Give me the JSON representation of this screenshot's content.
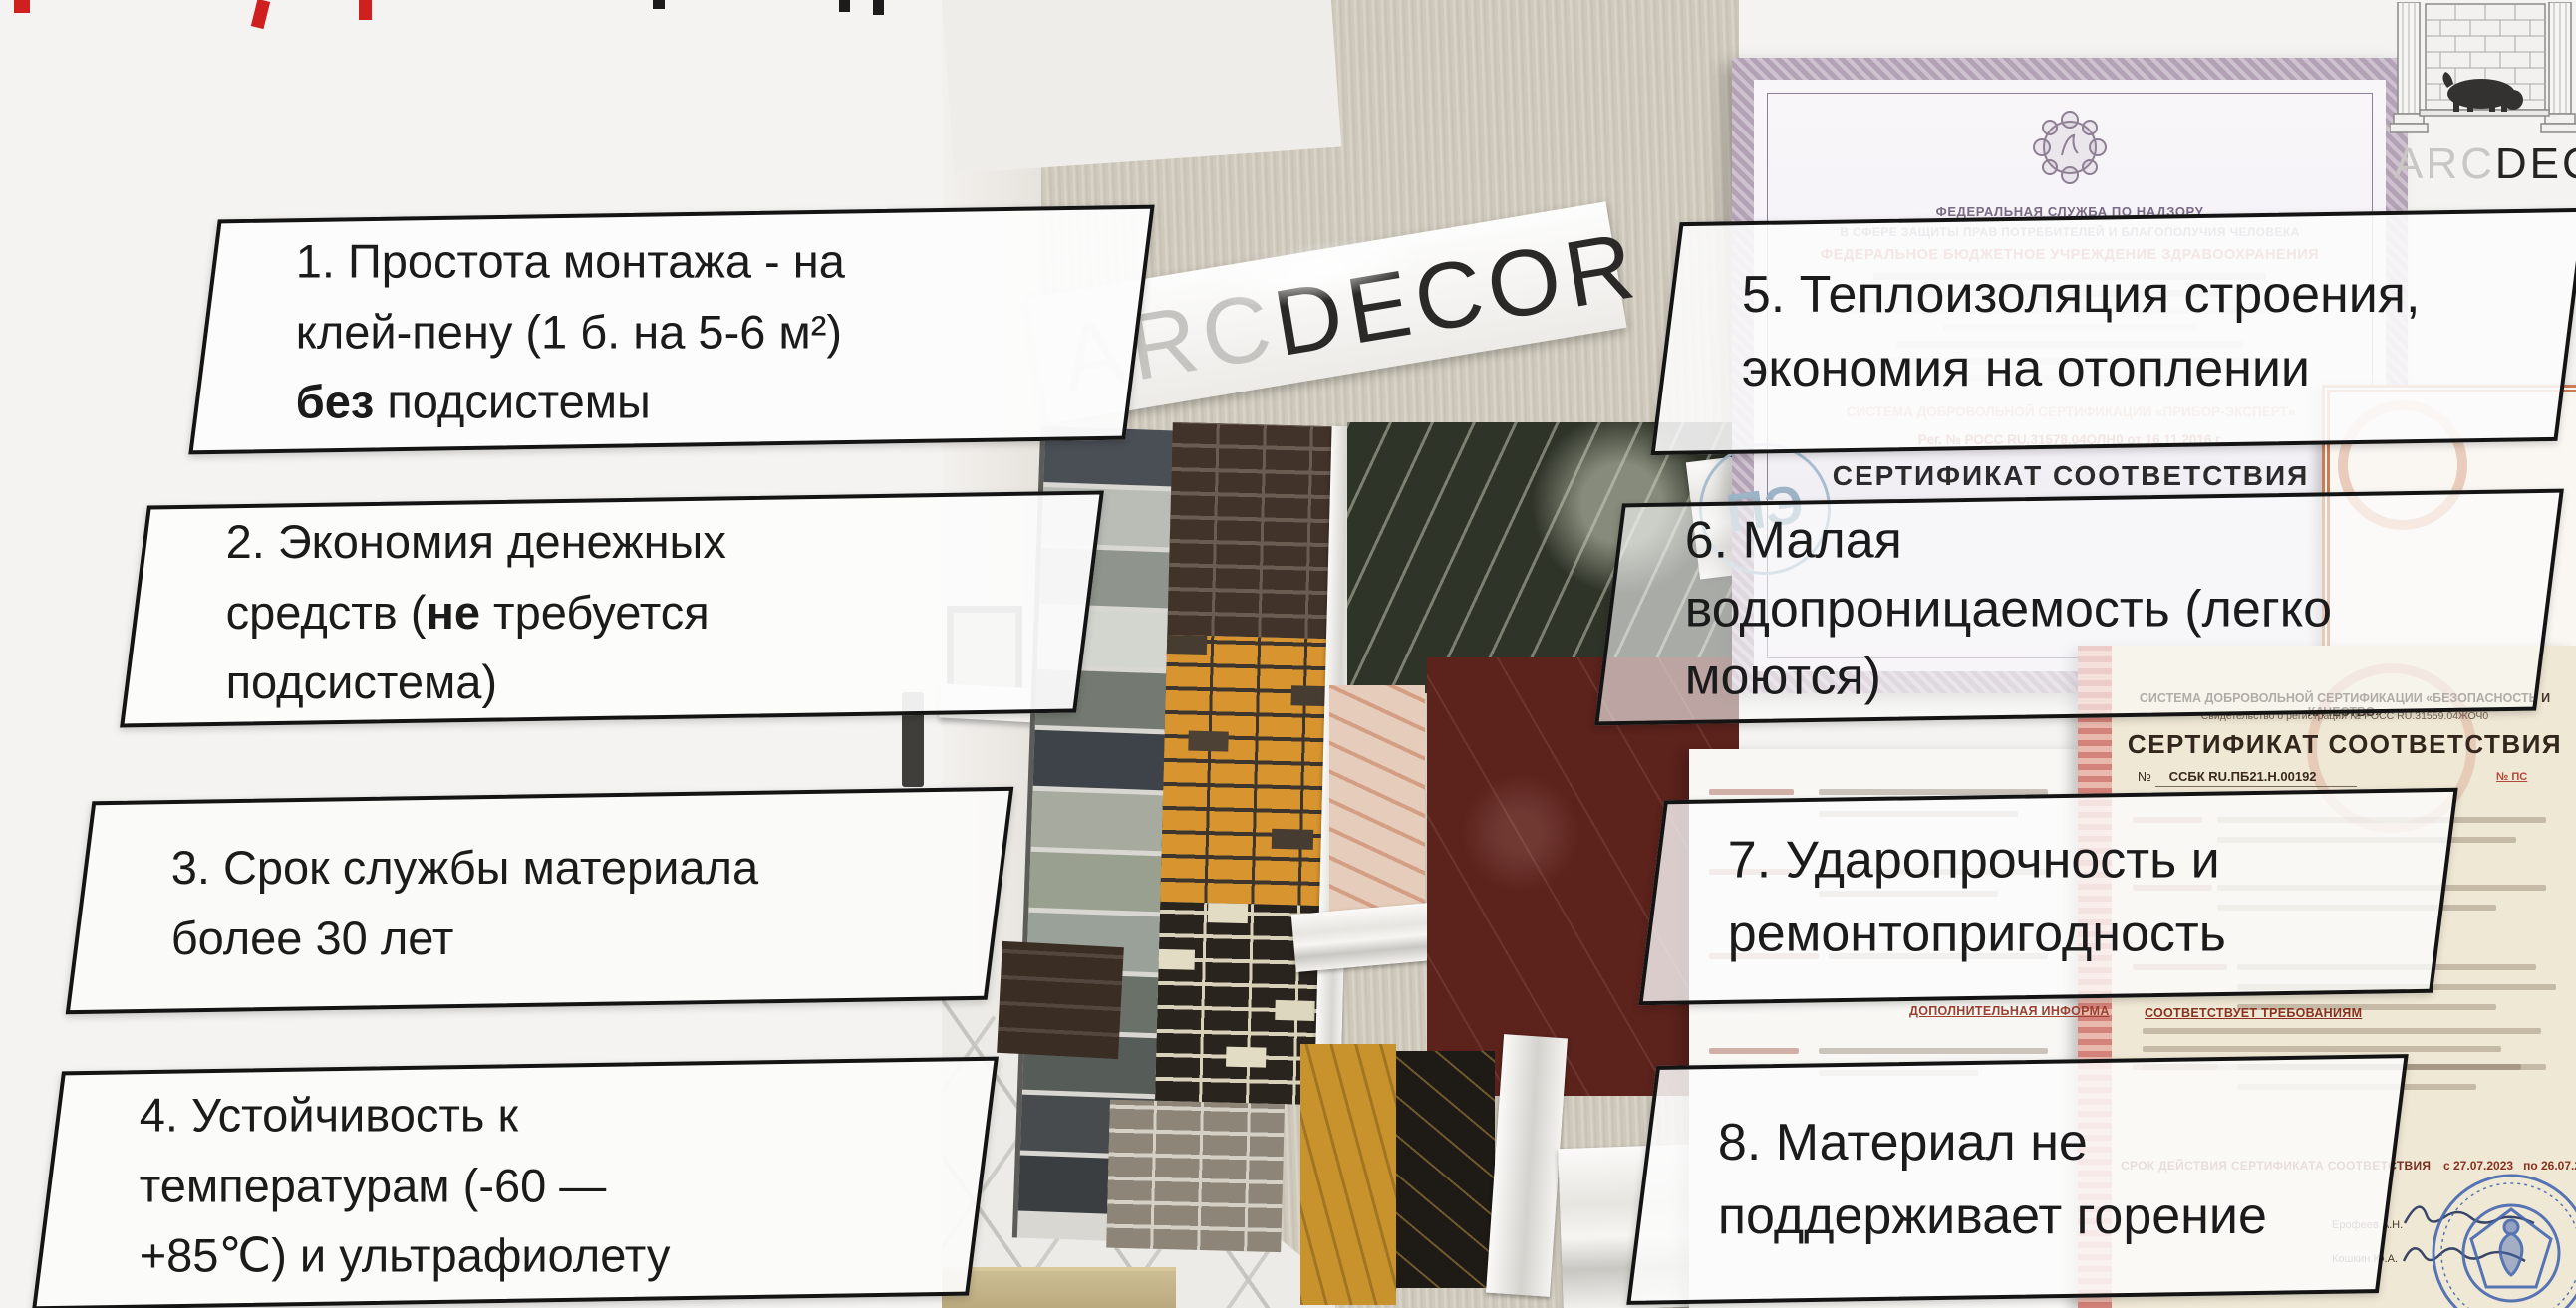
{
  "slide": {
    "background": "#f4f3f1",
    "accent_red": "#cf1f1f"
  },
  "callouts": {
    "text_color": "#1b1b1b",
    "border_color": "#141414",
    "boxes": [
      {
        "id": "1",
        "lines": [
          {
            "pre": "1. Простота монтажа - на"
          },
          {
            "pre": "клей-пену (1 б. на 5-6 м²)"
          },
          {
            "pre": "",
            "bold": "без",
            "post": " подсистемы"
          }
        ]
      },
      {
        "id": "2",
        "lines": [
          {
            "pre": "2. Экономия денежных"
          },
          {
            "pre": "средств (",
            "bold": "не",
            "post": " требуется"
          },
          {
            "pre": "подсистема)"
          }
        ]
      },
      {
        "id": "3",
        "lines": [
          {
            "pre": "3. Срок службы материала"
          },
          {
            "pre": "более 30 лет"
          }
        ]
      },
      {
        "id": "4",
        "lines": [
          {
            "pre": "4. Устойчивость к"
          },
          {
            "pre": "температурам (-60 —"
          },
          {
            "pre": "+85℃) и ультрафиолету"
          }
        ]
      },
      {
        "id": "5",
        "lines": [
          {
            "pre": "5. Теплоизоляция строения,"
          },
          {
            "pre": "экономия на отоплении"
          }
        ]
      },
      {
        "id": "6",
        "lines": [
          {
            "pre": "6. Малая"
          },
          {
            "pre": "водопроницаемость (легко"
          },
          {
            "pre": "моются)"
          }
        ]
      },
      {
        "id": "7",
        "lines": [
          {
            "pre": "7. Ударопрочность и"
          },
          {
            "pre": "ремонтопригодность"
          }
        ]
      },
      {
        "id": "8",
        "lines": [
          {
            "pre": "8. Материал не"
          },
          {
            "pre": "поддерживает горение"
          }
        ]
      }
    ]
  },
  "showroom": {
    "sign_gray": "ARC",
    "sign_black": "DECOR"
  },
  "logo": {
    "gray": "ARC",
    "black": "DECOR"
  },
  "certificates": {
    "rospotrebnadzor": {
      "line1": "ФЕДЕРАЛЬНАЯ СЛУЖБА ПО НАДЗОРУ",
      "line2": "В СФЕРЕ ЗАЩИТЫ ПРАВ ПОТРЕБИТЕЛЕЙ И БЛАГОПОЛУЧИЯ ЧЕЛОВЕКА",
      "line3": "ФЕДЕРАЛЬНОЕ БЮДЖЕТНОЕ УЧРЕЖДЕНИЕ ЗДРАВООХРАНЕНИЯ"
    },
    "pribor_expert": {
      "system": "СИСТЕМА ДОБРОВОЛЬНОЙ СЕРТИФИКАЦИИ «ПРИБОР-ЭКСПЕРТ»",
      "reg": "Рег. № РОСС RU.31578.04ОЛН0 от 16.11.2016 г.",
      "title": "СЕРТИФИКАТ СООТВЕТСТВИЯ",
      "stamp": "ПЭ"
    },
    "safety_quality": {
      "system": "СИСТЕМА ДОБРОВОЛЬНОЙ СЕРТИФИКАЦИИ «БЕЗОПАСНОСТЬ И КАЧЕСТВО»",
      "reg": "Свидетельство о регистрации № РОСС RU.31559.04ЖОЧ0",
      "title": "СЕРТИФИКАТ СООТВЕТСТВИЯ",
      "no_label": "№",
      "number": "ССБК RU.ПБ21.Н.00192",
      "ps_number": "№ ПС",
      "validity_label": "СРОК ДЕЙСТВИЯ СЕРТИФИКАТА СООТВЕТСТВИЯ",
      "validity": "с 27.07.2023   по 26.07.2028",
      "signer1": "Ерофеев А.Н.",
      "signer2": "Кошкин Ю.А."
    },
    "labels": {
      "additional_info": "ДОПОЛНИТЕЛЬНАЯ ИНФОРМА",
      "meets_requirements": "СООТВЕТСТВУЕТ ТРЕБОВАНИЯМ"
    }
  }
}
